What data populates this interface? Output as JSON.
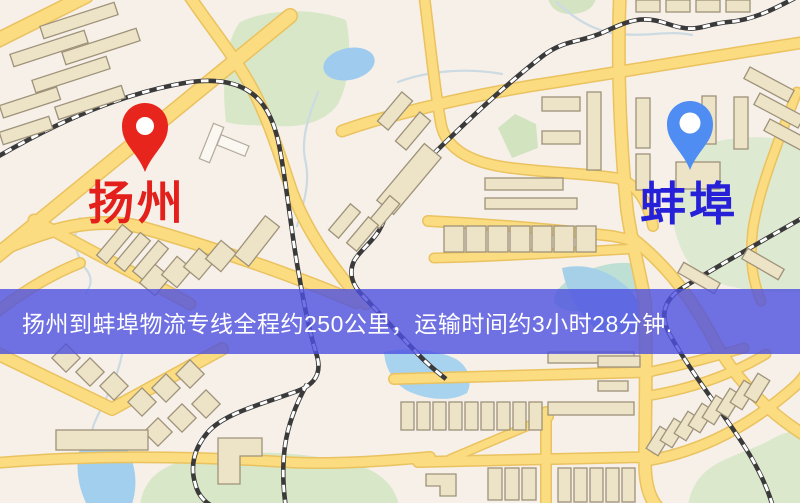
{
  "origin": {
    "name": "扬州"
  },
  "destination": {
    "name": "蚌埠"
  },
  "banner": {
    "text": "扬州到蚌埠物流专线全程约250公里，运输时间约3小时28分钟."
  },
  "route": {
    "distance_text": "约250公里",
    "duration_text": "约3小时28分钟"
  },
  "colors": {
    "origin_pin": "#e7251c",
    "origin_label": "#e3201b",
    "destination_pin": "#4f8df3",
    "destination_label": "#2621d8",
    "banner_bg": "rgba(78,80,224,0.80)",
    "banner_text": "#ffffff",
    "map_background": "#f6f0e9",
    "road": "#fbdc80",
    "road_casing": "#eac25f",
    "park": "#d8e7c8",
    "water": "#9fccee",
    "railway": "#3a3a3a",
    "building": "#ede3c6"
  }
}
